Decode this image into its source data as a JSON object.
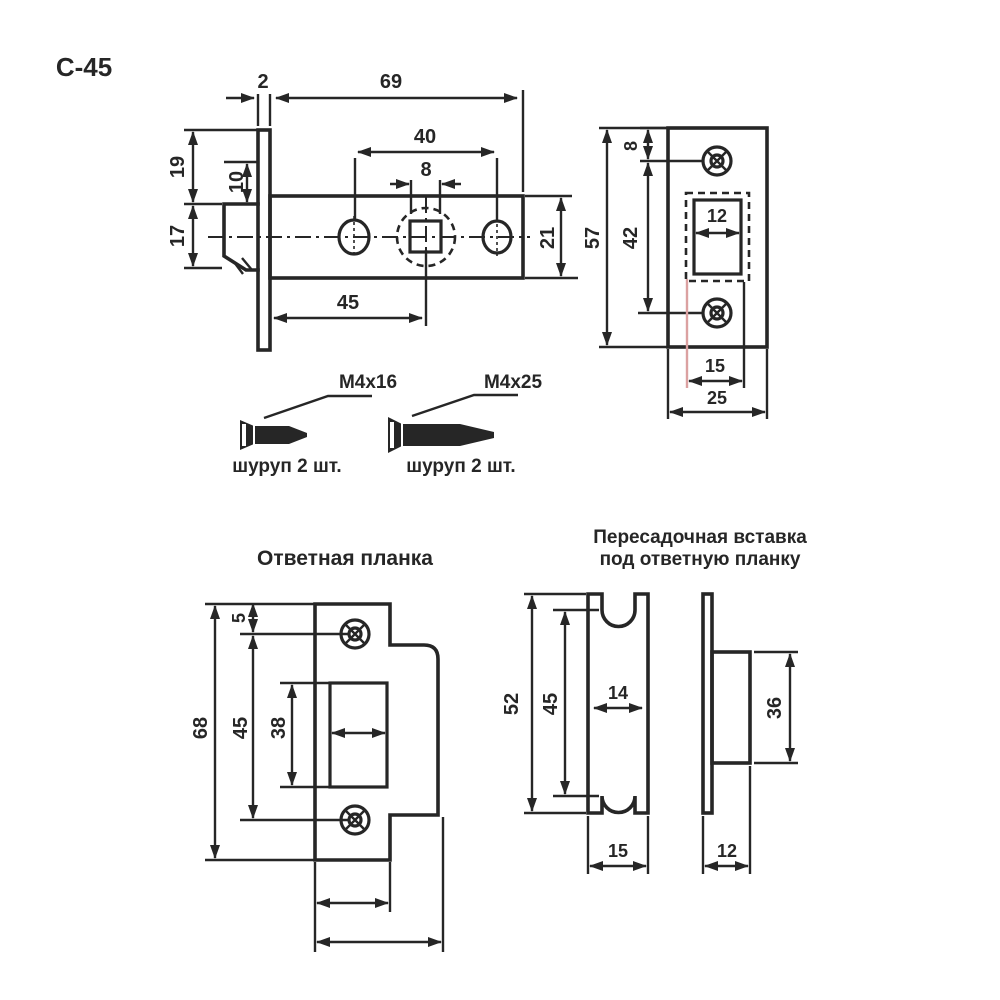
{
  "title": "С-45",
  "latch": {
    "thickness": "2",
    "length": "69",
    "hole_spacing": "40",
    "square": "8",
    "top_offset": "19",
    "bolt_offset": "10",
    "bolt_height": "17",
    "body_height": "21",
    "backset": "45"
  },
  "faceplate": {
    "top_offset": "8",
    "screw_spacing": "42",
    "height": "57",
    "cutout_width": "12",
    "slot_width": "15",
    "width": "25"
  },
  "screws": {
    "screw1": {
      "label": "М4х16",
      "qty": "шуруп 2 шт."
    },
    "screw2": {
      "label": "М4х25",
      "qty": "шуруп 2 шт."
    }
  },
  "strike": {
    "heading": "Ответная планка",
    "top_offset": "5",
    "height": "68",
    "screw_spacing": "45",
    "cutout_height": "38"
  },
  "insert": {
    "heading1": "Пересадочная вставка",
    "heading2": "под ответную планку",
    "height": "52",
    "notch_spacing": "45",
    "notch_width": "14",
    "width": "15",
    "side_height": "36",
    "side_width": "12"
  },
  "colors": {
    "ink": "#262626",
    "accent": "#dba1a1",
    "background": "#ffffff"
  }
}
